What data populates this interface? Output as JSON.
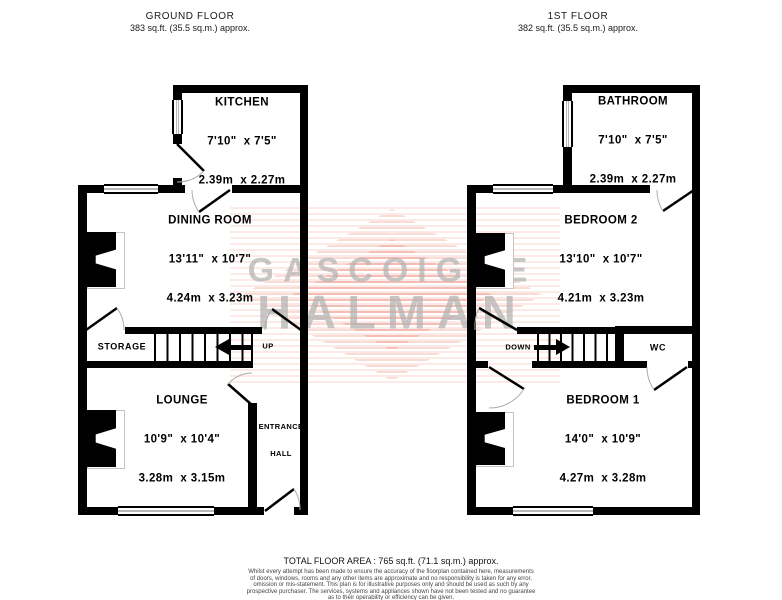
{
  "headers": {
    "ground": {
      "title": "GROUND FLOOR",
      "area": "383 sq.ft. (35.5 sq.m.) approx."
    },
    "first": {
      "title": "1ST FLOOR",
      "area": "382 sq.ft. (35.5 sq.m.) approx."
    }
  },
  "watermark": {
    "line1": "GASCOIGNE",
    "line2": "HALMAN"
  },
  "ground_floor": {
    "kitchen": {
      "name": "KITCHEN",
      "imperial": "7'10\"  x 7'5\"",
      "metric": "2.39m  x 2.27m"
    },
    "dining_room": {
      "name": "DINING ROOM",
      "imperial": "13'11\"  x 10'7\"",
      "metric": "4.24m  x 3.23m"
    },
    "lounge": {
      "name": "LOUNGE",
      "imperial": "10'9\"  x 10'4\"",
      "metric": "3.28m  x 3.15m"
    },
    "storage_label": "STORAGE",
    "up_label": "UP",
    "entrance_hall_line1": "ENTRANCE",
    "entrance_hall_line2": "HALL"
  },
  "first_floor": {
    "bathroom": {
      "name": "BATHROOM",
      "imperial": "7'10\"  x 7'5\"",
      "metric": "2.39m  x 2.27m"
    },
    "bedroom2": {
      "name": "BEDROOM 2",
      "imperial": "13'10\"  x 10'7\"",
      "metric": "4.21m  x 3.23m"
    },
    "bedroom1": {
      "name": "BEDROOM 1",
      "imperial": "14'0\"  x 10'9\"",
      "metric": "4.27m  x 3.28m"
    },
    "down_label": "DOWN",
    "wc_label": "WC"
  },
  "footer": {
    "total_area": "TOTAL FLOOR AREA : 765 sq.ft. (71.1 sq.m.) approx.",
    "disclaimer_lines": [
      "Whilst every attempt has been made to ensure the accuracy of the floorplan contained here, measurements",
      "of doors, windows, rooms and any other items are approximate and no responsibility is taken for any error,",
      "omission or mis-statement. This plan is for illustrative purposes only and should be used as such by any",
      "prospective purchaser. The services, systems and appliances shown have not been tested and no guarantee",
      "as to their operability or efficiency can be given."
    ],
    "made_with": "Made with Metropix ©2024"
  },
  "colors": {
    "wall": "#000000",
    "watermark_stripe": "#e8604c",
    "watermark_text": "#b2b2b2"
  }
}
